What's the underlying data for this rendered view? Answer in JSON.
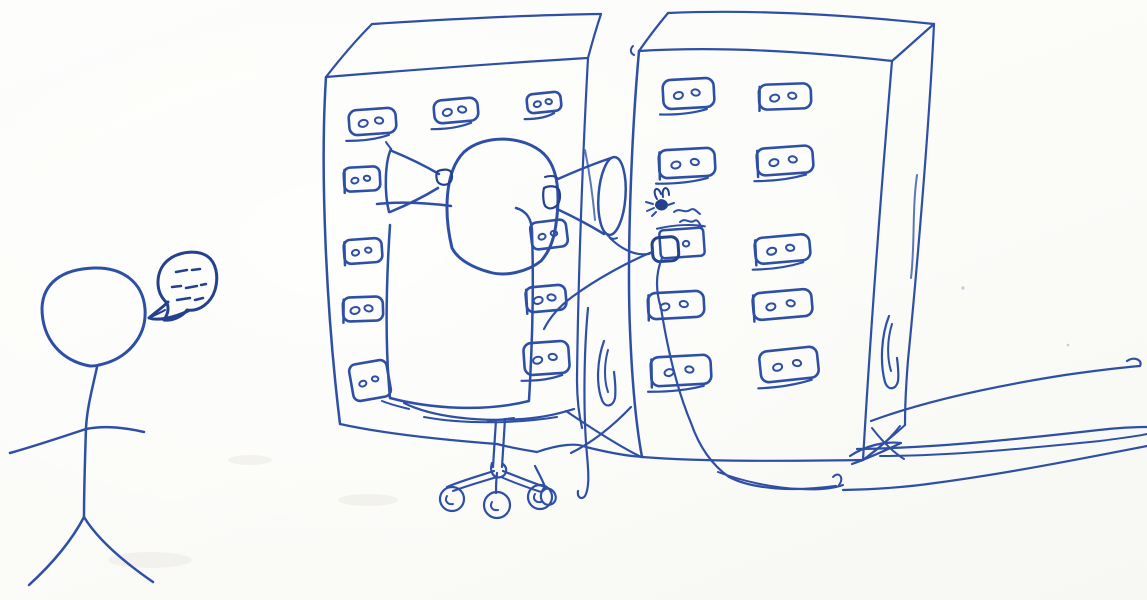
{
  "scene": {
    "medium": "hand-drawn ballpoint pen sketch",
    "description": "A stick figure stands at the left muttering into a small speech bubble. Two tall server cabinets with rows of two-dot vent slots dominate the scene. An office swivel chair sits in front of the gap between the cabinets; a bald head peeks over the chair back wearing two ear-trumpet listening horns. The right horn is wired to a small socket box on the right cabinet, above which a little fly buzzes. Tangled cables run along the floor and out of frame to the right.",
    "paper_color": "#fcfcfa",
    "ink_color": "#2e4fa6",
    "ink_dark": "#24418f",
    "ink_light": "#5b76bb"
  },
  "objects": [
    {
      "name": "stick-figure",
      "desc": "person standing at left, speaking"
    },
    {
      "name": "speech-bubble",
      "desc": "small bubble filled with unreadable dashes (muttering)"
    },
    {
      "name": "left-server-cabinet",
      "desc": "tall box in perspective with ten vent slots"
    },
    {
      "name": "right-server-cabinet",
      "desc": "tall box in perspective with nine vent slots and a socket box"
    },
    {
      "name": "office-chair",
      "desc": "swivel chair on a star base with three caster wheels"
    },
    {
      "name": "seated-person-head",
      "desc": "bald head visible above the chair back"
    },
    {
      "name": "ear-horns",
      "desc": "two trumpet-shaped listening horns attached to the head"
    },
    {
      "name": "fly",
      "desc": "small fly doodle with squiggle trail near the socket"
    },
    {
      "name": "socket-box",
      "desc": "plug/socket box on the right cabinet front"
    },
    {
      "name": "cables",
      "desc": "several cables crisscrossing the floor toward the right edge"
    }
  ],
  "left_cabinet": {
    "vents": [
      {
        "x": 349,
        "y": 109,
        "w": 47,
        "h": 25,
        "rot": -4,
        "underline": true
      },
      {
        "x": 434,
        "y": 99,
        "w": 44,
        "h": 23,
        "rot": -5,
        "underline": true
      },
      {
        "x": 527,
        "y": 93,
        "w": 34,
        "h": 19,
        "rot": -6,
        "underline": true
      },
      {
        "x": 344,
        "y": 167,
        "w": 36,
        "h": 24,
        "rot": -3,
        "ltick": true
      },
      {
        "x": 344,
        "y": 239,
        "w": 38,
        "h": 24,
        "rot": -4,
        "ltick": true
      },
      {
        "x": 343,
        "y": 297,
        "w": 40,
        "h": 24,
        "rot": -2,
        "ltick": true
      },
      {
        "x": 351,
        "y": 362,
        "w": 38,
        "h": 37,
        "rot": -10
      },
      {
        "x": 531,
        "y": 221,
        "w": 36,
        "h": 27,
        "rot": -7
      },
      {
        "x": 526,
        "y": 286,
        "w": 40,
        "h": 25,
        "rot": -5,
        "ltick": true
      },
      {
        "x": 524,
        "y": 342,
        "w": 45,
        "h": 32,
        "rot": -4,
        "underline": true
      }
    ]
  },
  "right_cabinet": {
    "vents": [
      {
        "x": 663,
        "y": 79,
        "w": 51,
        "h": 29,
        "rot": -3,
        "underline": true
      },
      {
        "x": 759,
        "y": 84,
        "w": 52,
        "h": 25,
        "rot": -2,
        "ltick": true
      },
      {
        "x": 659,
        "y": 149,
        "w": 56,
        "h": 28,
        "rot": -3,
        "underline": true,
        "ltick": true
      },
      {
        "x": 757,
        "y": 147,
        "w": 56,
        "h": 27,
        "rot": -4,
        "underline": true,
        "ltick": true
      },
      {
        "x": 755,
        "y": 236,
        "w": 55,
        "h": 26,
        "rot": -5,
        "underline": true,
        "ltick": true
      },
      {
        "x": 648,
        "y": 292,
        "w": 56,
        "h": 26,
        "rot": -3,
        "ltick": true
      },
      {
        "x": 753,
        "y": 291,
        "w": 59,
        "h": 27,
        "rot": -5,
        "ltick": true
      },
      {
        "x": 651,
        "y": 356,
        "w": 60,
        "h": 29,
        "rot": -3,
        "underline": true,
        "ltick": true
      },
      {
        "x": 760,
        "y": 349,
        "w": 58,
        "h": 31,
        "rot": -6,
        "underline": true
      }
    ],
    "socket": {
      "box": {
        "x": 660,
        "y": 229,
        "w": 44,
        "h": 28,
        "rot": -4
      },
      "plug": {
        "x": 652,
        "y": 236,
        "w": 26,
        "h": 24,
        "rot": -4
      },
      "dot": {
        "cx": 686,
        "cy": 244
      }
    }
  },
  "chair": {
    "wheels": [
      {
        "cx": 452,
        "cy": 499,
        "r": 12
      },
      {
        "cx": 497,
        "cy": 505,
        "r": 13
      },
      {
        "cx": 540,
        "cy": 497,
        "r": 12
      }
    ]
  },
  "speech_bubble": {
    "dashes": [
      [
        176,
        272,
        187,
        270
      ],
      [
        192,
        270,
        200,
        269
      ],
      [
        172,
        287,
        181,
        286
      ],
      [
        186,
        288,
        197,
        286
      ],
      [
        201,
        285,
        206,
        284
      ],
      [
        177,
        300,
        190,
        298
      ],
      [
        195,
        300,
        203,
        298
      ]
    ]
  }
}
